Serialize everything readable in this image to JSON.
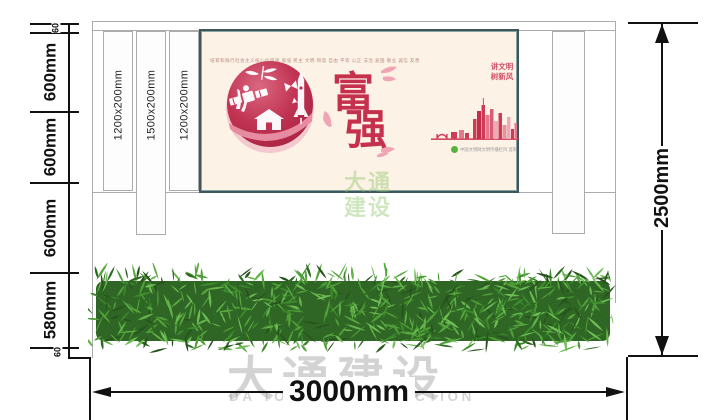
{
  "poster": {
    "values_line": "培育和践行社会主义核心价值观    富强  民主  文明  和谐  自由  平等  公正  法治  爱国  敬业  诚信  友善",
    "char_top": "富",
    "char_bottom": "强",
    "slogan_line1": "讲文明",
    "slogan_line2": "树新风",
    "credit_text": "中国文明网文明传播栏目 监制"
  },
  "posts": {
    "left": [
      "1200x200mm",
      "1500x200mm",
      "1200x200mm"
    ]
  },
  "dimensions": {
    "left_chain": [
      "60",
      "600mm",
      "600mm",
      "600mm",
      "580mm",
      "60"
    ],
    "right_total": "2500mm",
    "bottom_total": "3000mm"
  },
  "watermark": {
    "cn": "大通建设",
    "en": "DA TONG CONSTRUCTION"
  },
  "colors": {
    "dimension": "#111111",
    "wall_line": "#ababab",
    "poster_border": "#3f565c",
    "poster_bg": "#fcf2e6",
    "emblem_red": "#c13352",
    "char_red": "#c5304d",
    "slogan_red": "#d05368",
    "skyline_red": "#cf3b56",
    "hedge_green": "#3c8a2c",
    "watermark_gray": "#999999",
    "watermark_green": "#8dc665",
    "credit_green": "#57b33e"
  }
}
